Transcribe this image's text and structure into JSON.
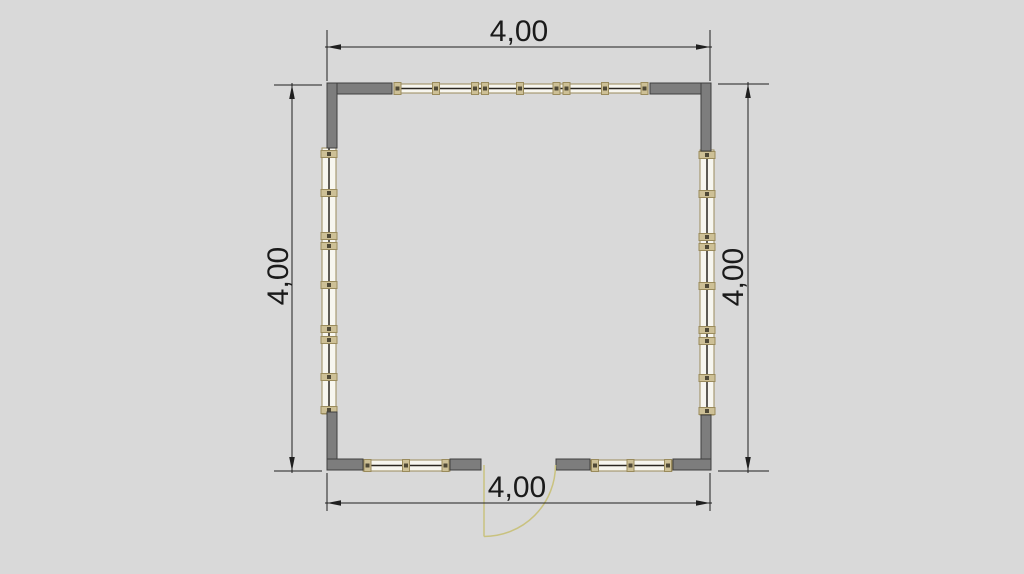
{
  "drawing": {
    "type": "architectural floor plan",
    "room_shape": "square",
    "door_position": "bottom-center",
    "door_symbol": "quarter-circle swing arc",
    "window_walls": [
      "top",
      "left",
      "right",
      "bottom-left",
      "bottom-right"
    ]
  },
  "dimensions": {
    "top": {
      "label": "4,00"
    },
    "bottom": {
      "label": "4,00"
    },
    "left": {
      "label": "4,00"
    },
    "right": {
      "label": "4,00"
    }
  },
  "colors": {
    "background": "#d9d9d9",
    "wall_fill": "#7d7d7d",
    "wall_outline": "#3f3f3f",
    "window_frame": "#9a8b5c",
    "window_glazing": "#f7f6ef",
    "window_mullion_fill": "#cdc096",
    "window_mullion_core": "#4f4936",
    "window_center_line": "#2a2620",
    "door_swing": "#c9c27f",
    "dimension_line": "#1f1f1f",
    "dimension_text": "#1a1a1a"
  }
}
